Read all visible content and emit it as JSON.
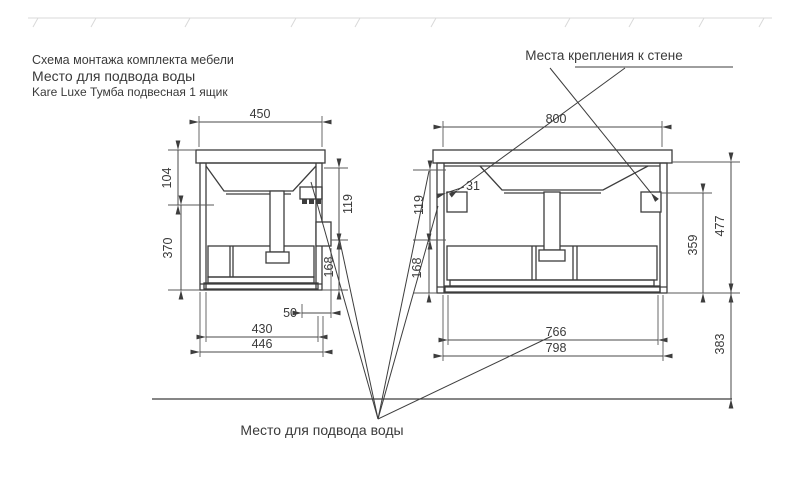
{
  "title_block": {
    "line1": "Схема монтажа комплекта мебели",
    "line2": "Место для подвода воды",
    "line3": "Kare Luxe Тумба подвесная 1 ящик"
  },
  "annotations": {
    "wall_mount_label": "Места крепления к стене",
    "water_supply_label": "Место для подвода воды"
  },
  "side_view": {
    "dims": {
      "top_width": "450",
      "basin_height": "104",
      "body_height": "370",
      "upper_gap": "119",
      "lower_gap": "168",
      "rail_offset": "50",
      "depth_inner": "430",
      "depth_outer": "446"
    }
  },
  "front_view": {
    "dims": {
      "top_width": "800",
      "bracket_inset": "31",
      "upper_gap": "119",
      "lower_gap": "168",
      "body_height": "359",
      "total_height": "477",
      "floor_distance": "383",
      "bottom_inner_width": "766",
      "bottom_outer_width": "798"
    }
  },
  "colors": {
    "line": "#3d3d3d",
    "text": "#3a3a3a",
    "wall_hatch": "#d9d9d9",
    "background": "#ffffff"
  }
}
